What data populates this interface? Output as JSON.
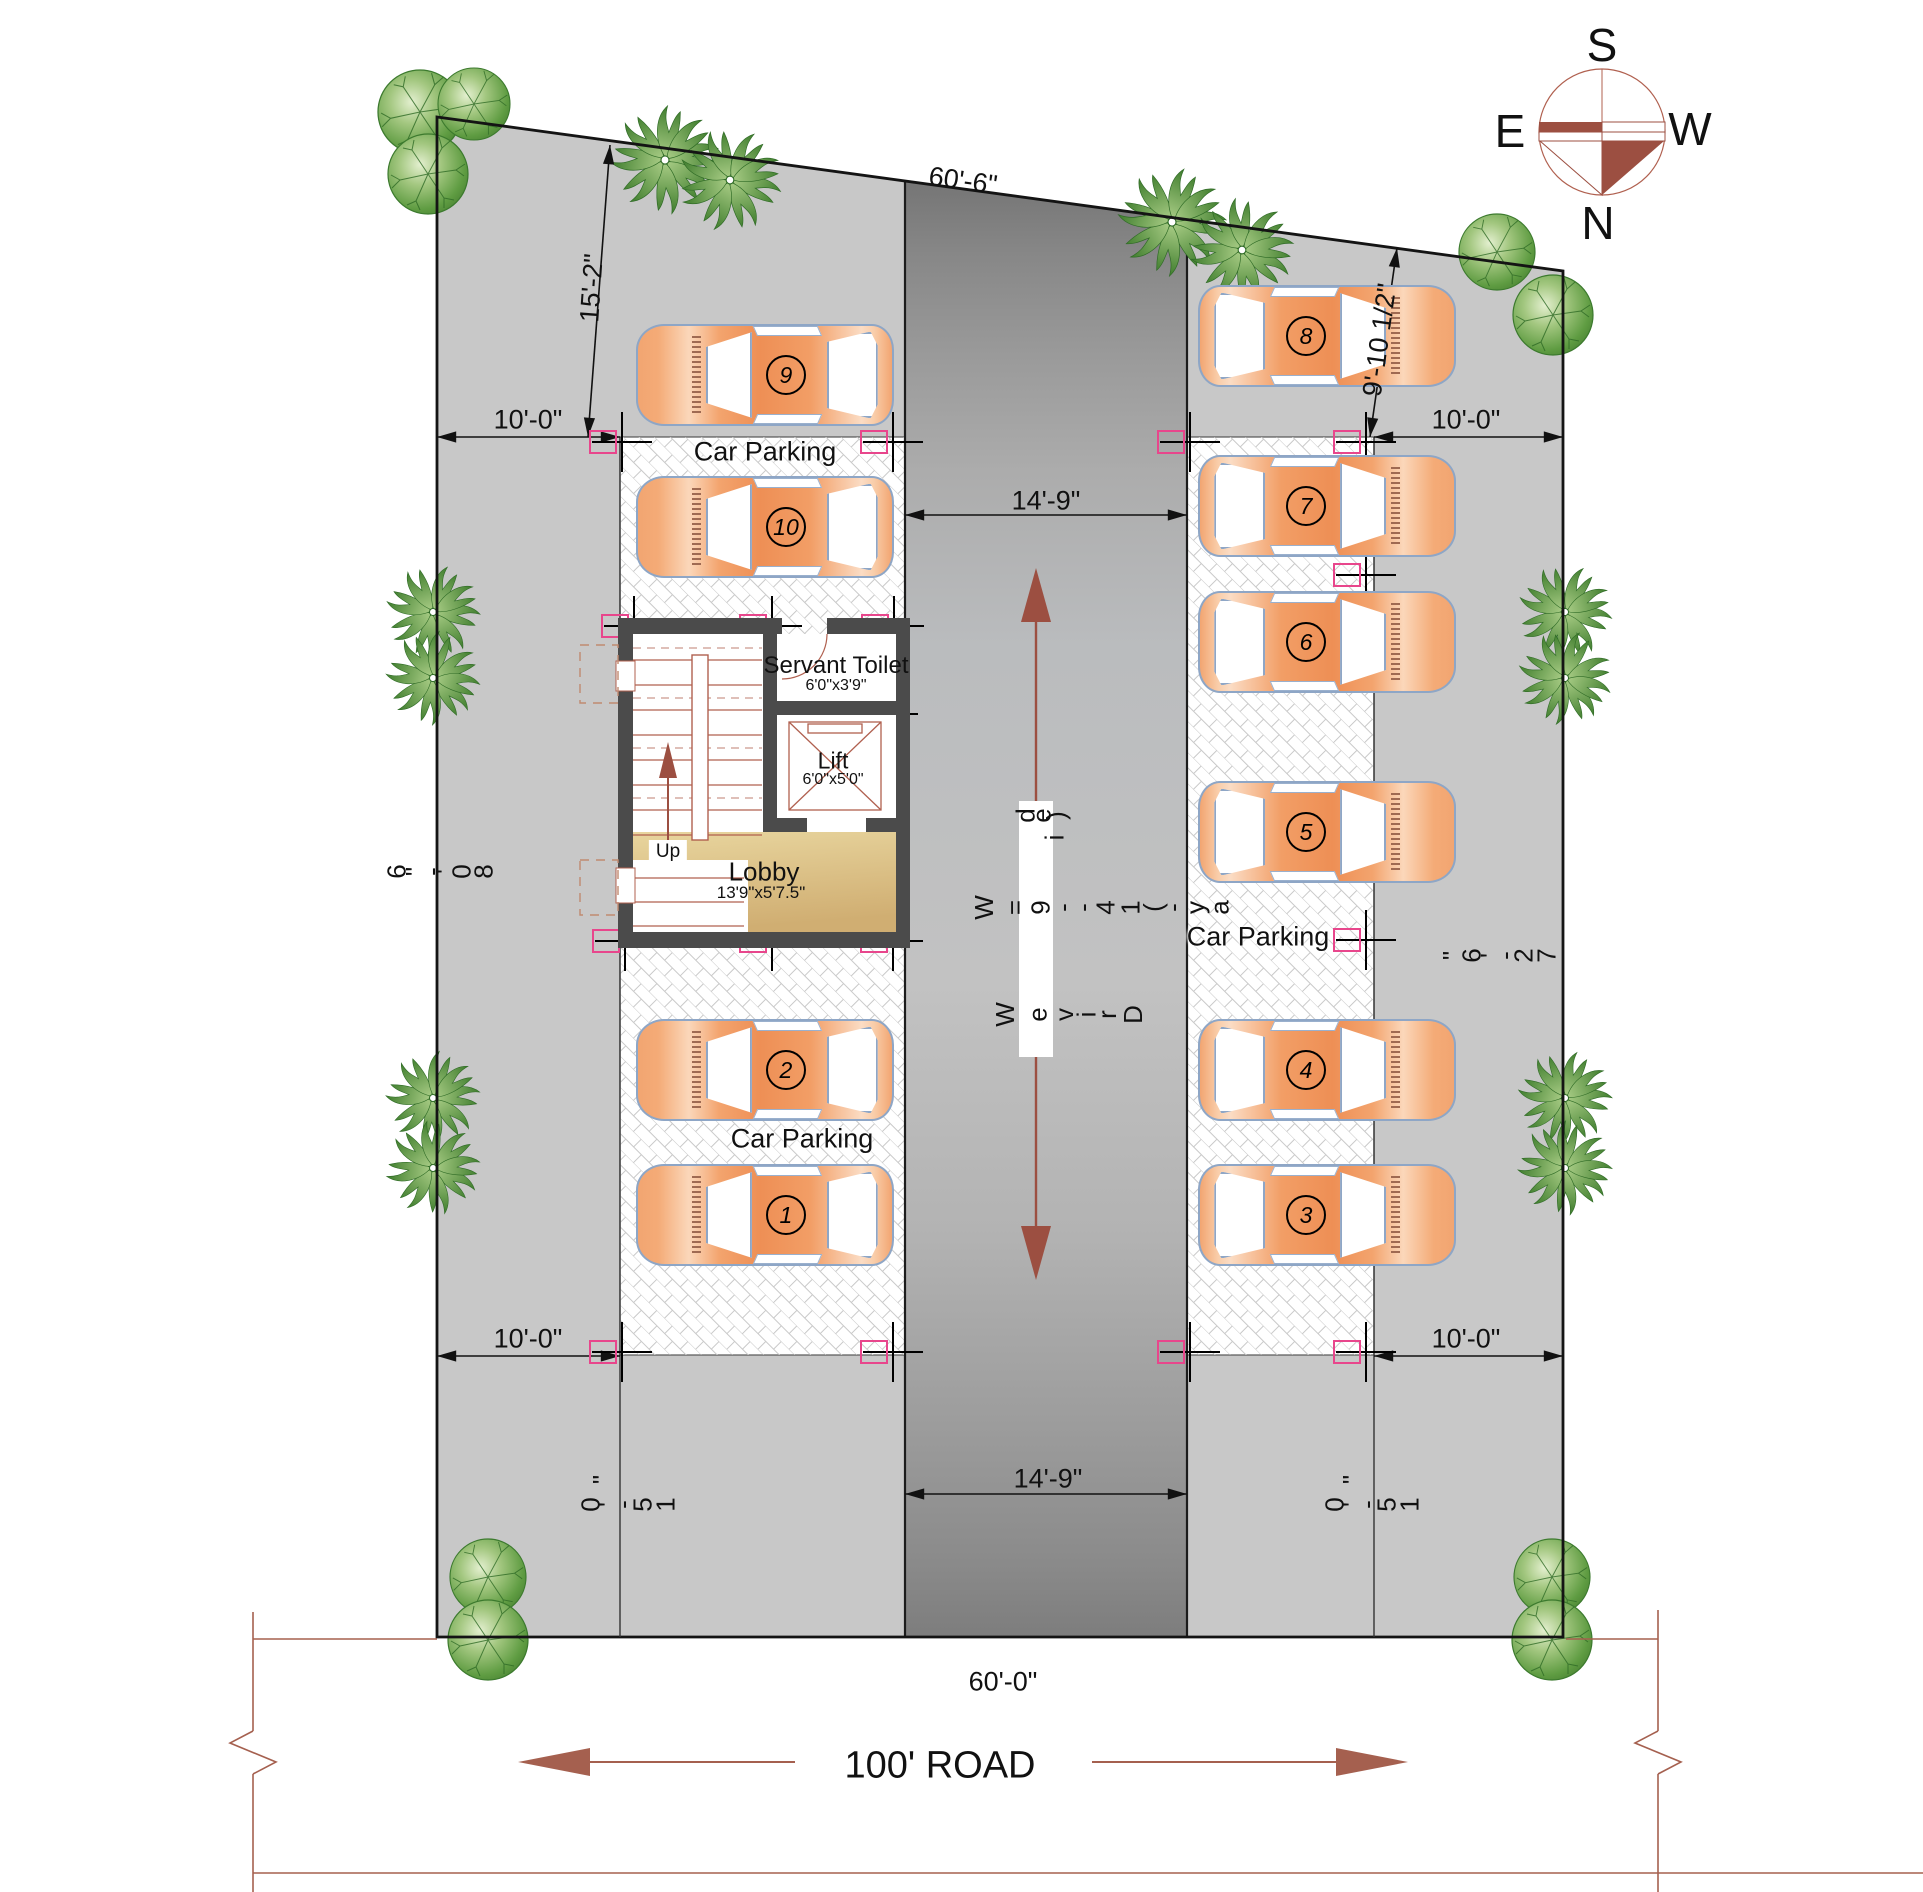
{
  "compass": {
    "south": "S",
    "west": "W",
    "north": "N",
    "east": "E"
  },
  "road": {
    "label": "100' ROAD"
  },
  "plot": {
    "dim_top": "60'-6\"",
    "dim_bottom": "60'-0\"",
    "dim_left_glyphs": "6\"-'08",
    "dim_left_value": "80'-6\"",
    "dim_right_glyphs": "\"6'-27",
    "dim_right_value": "72'-6\""
  },
  "setbacks": {
    "top_left": "15'-2\"",
    "top_right": "9'-10 1/2\"",
    "top_left_side": "10'-0\"",
    "top_right_side": "10'-0\"",
    "bottom_left_side": "10'-0\"",
    "bottom_right_side": "10'-0\"",
    "bottom_left_glyphs_a": "\"",
    "bottom_left_glyphs_b": "0'-51",
    "bottom_right_glyphs_a": "\"",
    "bottom_right_glyphs_b": "0'-51",
    "bottom_value": "15'-0\""
  },
  "driveway": {
    "label": "Drive Way (14'-9\" Wide)",
    "width_top": "14'-9\"",
    "width_bottom": "14'-9\"",
    "glyphs_top": "de)",
    "glyphs_top_b": "i",
    "glyphs_mid": "W=9--41(-ya",
    "glyphs_bottom": "WevirD"
  },
  "core": {
    "servant_toilet": {
      "name": "Servant Toilet",
      "size": "6'0\"x3'9\""
    },
    "lift": {
      "name": "Lift",
      "size": "6'0\"x5'0\""
    },
    "lobby": {
      "name": "Lobby",
      "size": "13'9\"x5'7.5\""
    },
    "stairs": {
      "label": "Up"
    }
  },
  "parking": {
    "label_top_left": "Car Parking",
    "label_bottom_left": "Car Parking",
    "label_right": "Car Parking",
    "spots": [
      {
        "number": "1"
      },
      {
        "number": "2"
      },
      {
        "number": "3"
      },
      {
        "number": "4"
      },
      {
        "number": "5"
      },
      {
        "number": "6"
      },
      {
        "number": "7"
      },
      {
        "number": "8"
      },
      {
        "number": "9"
      },
      {
        "number": "10"
      }
    ]
  }
}
